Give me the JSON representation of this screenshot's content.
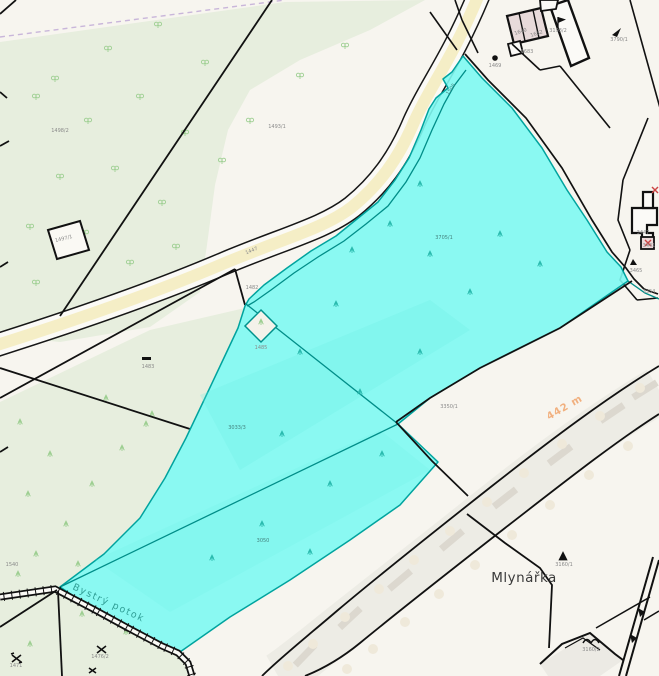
{
  "map": {
    "type": "cadastral-map-viewer",
    "place_label": "Mlynářka",
    "stream_label": "Bystrý potok",
    "distance_label": "442 m",
    "selection_color": "#7dfaf2",
    "selection_border_color": "#00a39e",
    "road_fill_color": "#f5eec6",
    "forest_fill_color": "#e7eede",
    "stream_label_color": "#2f9e95",
    "distance_label_color": "#f0a064",
    "selected_parcel_numbers": [
      "1505",
      "3705/1",
      "3033/3",
      "3050"
    ]
  },
  "parcel_labels": [
    {
      "text": "1498/2",
      "x": 60,
      "y": 132,
      "r": 0
    },
    {
      "text": "1493/1",
      "x": 277,
      "y": 128,
      "r": 0
    },
    {
      "text": "1497/1",
      "x": 64,
      "y": 240,
      "r": -14
    },
    {
      "text": "1483",
      "x": 148,
      "y": 368,
      "r": 0
    },
    {
      "text": "1447",
      "x": 252,
      "y": 252,
      "r": -22
    },
    {
      "text": "1482",
      "x": 252,
      "y": 289,
      "r": 0
    },
    {
      "text": "1485",
      "x": 261,
      "y": 349,
      "r": 0
    },
    {
      "text": "1505",
      "x": 452,
      "y": 90,
      "r": -55,
      "cls": "cy"
    },
    {
      "text": "3705/1",
      "x": 444,
      "y": 239,
      "r": 0,
      "cls": "cy"
    },
    {
      "text": "3033/3",
      "x": 237,
      "y": 429,
      "r": 0,
      "cls": "cy"
    },
    {
      "text": "3050",
      "x": 263,
      "y": 542,
      "r": 0,
      "cls": "cy"
    },
    {
      "text": "3350/1",
      "x": 449,
      "y": 408,
      "r": 0
    },
    {
      "text": "1469",
      "x": 495,
      "y": 67,
      "r": 0
    },
    {
      "text": "1640",
      "x": 521,
      "y": 33,
      "r": -18,
      "cls": "bld"
    },
    {
      "text": "1682",
      "x": 537,
      "y": 35,
      "r": -18,
      "cls": "bld"
    },
    {
      "text": "1683",
      "x": 527,
      "y": 53,
      "r": 0
    },
    {
      "text": "3193/2",
      "x": 558,
      "y": 32,
      "r": 0
    },
    {
      "text": "3790/1",
      "x": 619,
      "y": 41,
      "r": 0
    },
    {
      "text": "3447",
      "x": 643,
      "y": 234,
      "r": 0
    },
    {
      "text": "3441",
      "x": 649,
      "y": 247,
      "r": 0
    },
    {
      "text": "3465",
      "x": 636,
      "y": 272,
      "r": 0
    },
    {
      "text": "3354",
      "x": 649,
      "y": 293,
      "r": 0
    },
    {
      "text": "3160/1",
      "x": 564,
      "y": 566,
      "r": 0
    },
    {
      "text": "3160/2",
      "x": 591,
      "y": 651,
      "r": 0
    },
    {
      "text": "1471",
      "x": 16,
      "y": 667,
      "r": 0
    },
    {
      "text": "1476/2",
      "x": 100,
      "y": 658,
      "r": 0
    },
    {
      "text": "1540",
      "x": 12,
      "y": 566,
      "r": 0
    }
  ]
}
